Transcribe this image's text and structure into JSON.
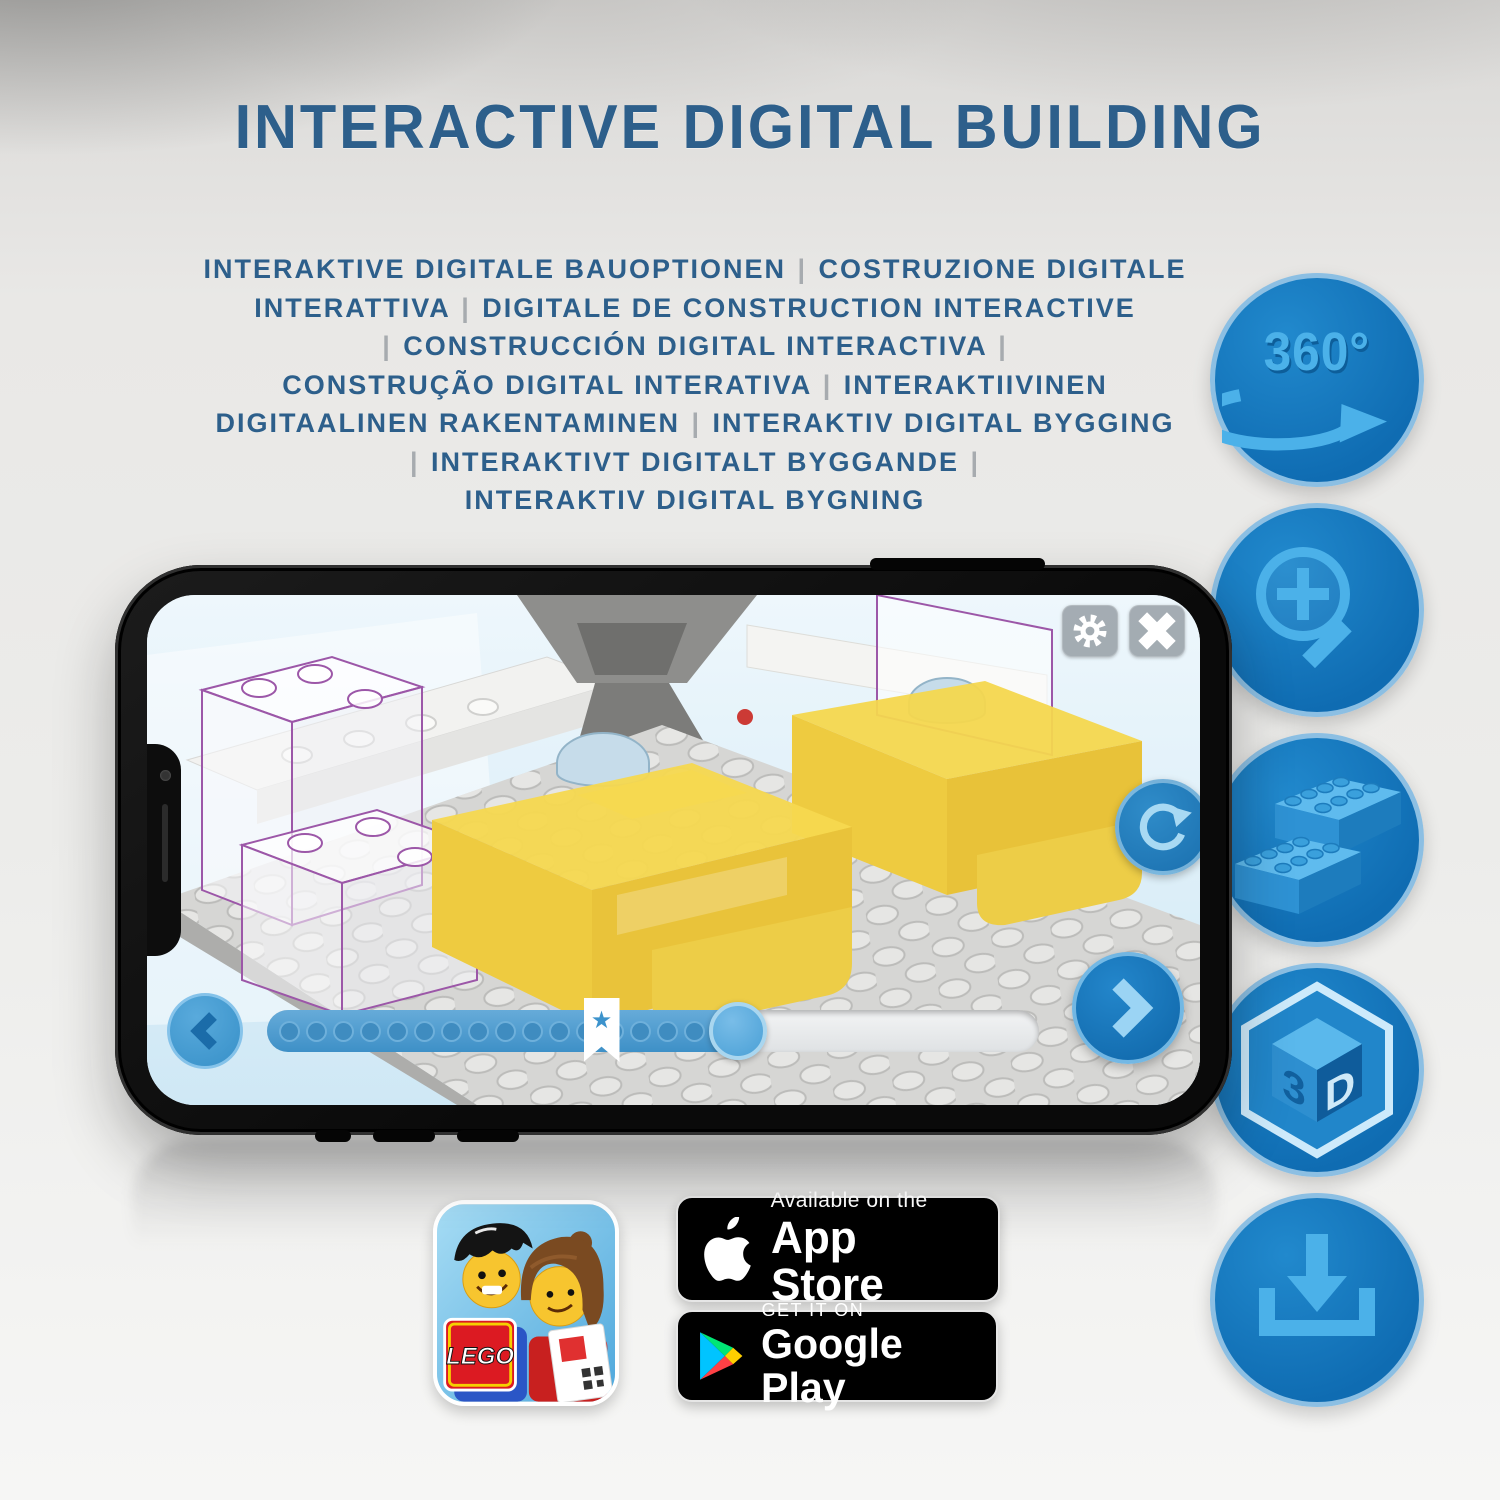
{
  "title": "INTERACTIVE DIGITAL BUILDING",
  "subtitle_lines": [
    "INTERAKTIVE DIGITALE BAUOPTIONEN | COSTRUZIONE DIGITALE",
    "INTERATTIVA | DIGITALE DE CONSTRUCTION INTERACTIVE",
    "| CONSTRUCCIÓN DIGITAL INTERACTIVA |",
    "CONSTRUÇÃO DIGITAL INTERATIVA | INTERAKTIIVINEN",
    "DIGITAALINEN RAKENTAMINEN | INTERAKTIV DIGITAL BYGGING",
    "| INTERAKTIVT DIGITALT BYGGANDE |",
    "INTERAKTIV DIGITAL BYGNING"
  ],
  "feature_icons": {
    "rotation_360": {
      "label": "360°",
      "icon": "360-rotate-arrow-icon"
    },
    "zoom": {
      "icon": "magnifier-plus-icon"
    },
    "bricks": {
      "icon": "lego-bricks-icon"
    },
    "cube_3d": {
      "icon": "3d-cube-icon",
      "left_face": "3",
      "right_face": "D"
    },
    "download": {
      "icon": "download-tray-icon"
    }
  },
  "phone": {
    "screen_controls": {
      "settings_icon": "gear-icon",
      "close_icon": "close-x-icon",
      "rotate_icon": "rotate-arrow-icon",
      "prev_icon": "chevron-left-icon",
      "next_icon": "chevron-right-icon",
      "progress": {
        "filled_percent": 61,
        "bookmark_percent": 41,
        "dot_count": 17,
        "star_glyph": "★"
      }
    }
  },
  "badges": {
    "app_store": {
      "line1": "Available on the",
      "line2": "App Store",
      "icon": "apple-logo-icon"
    },
    "google_play": {
      "line1": "GET IT ON",
      "line2": "Google Play",
      "icon": "google-play-triangle-icon"
    }
  },
  "app_icon": {
    "logo_text": "LEGO"
  },
  "colors": {
    "heading_blue": "#2d5f8b",
    "pipe_grey": "#a7abaf",
    "icon_circle_blue": "#1478bd",
    "icon_rim_blue": "#8cbfe3",
    "icon_glyph_blue": "#4bb1e9",
    "app_accent_blue": "#3c93cc"
  }
}
